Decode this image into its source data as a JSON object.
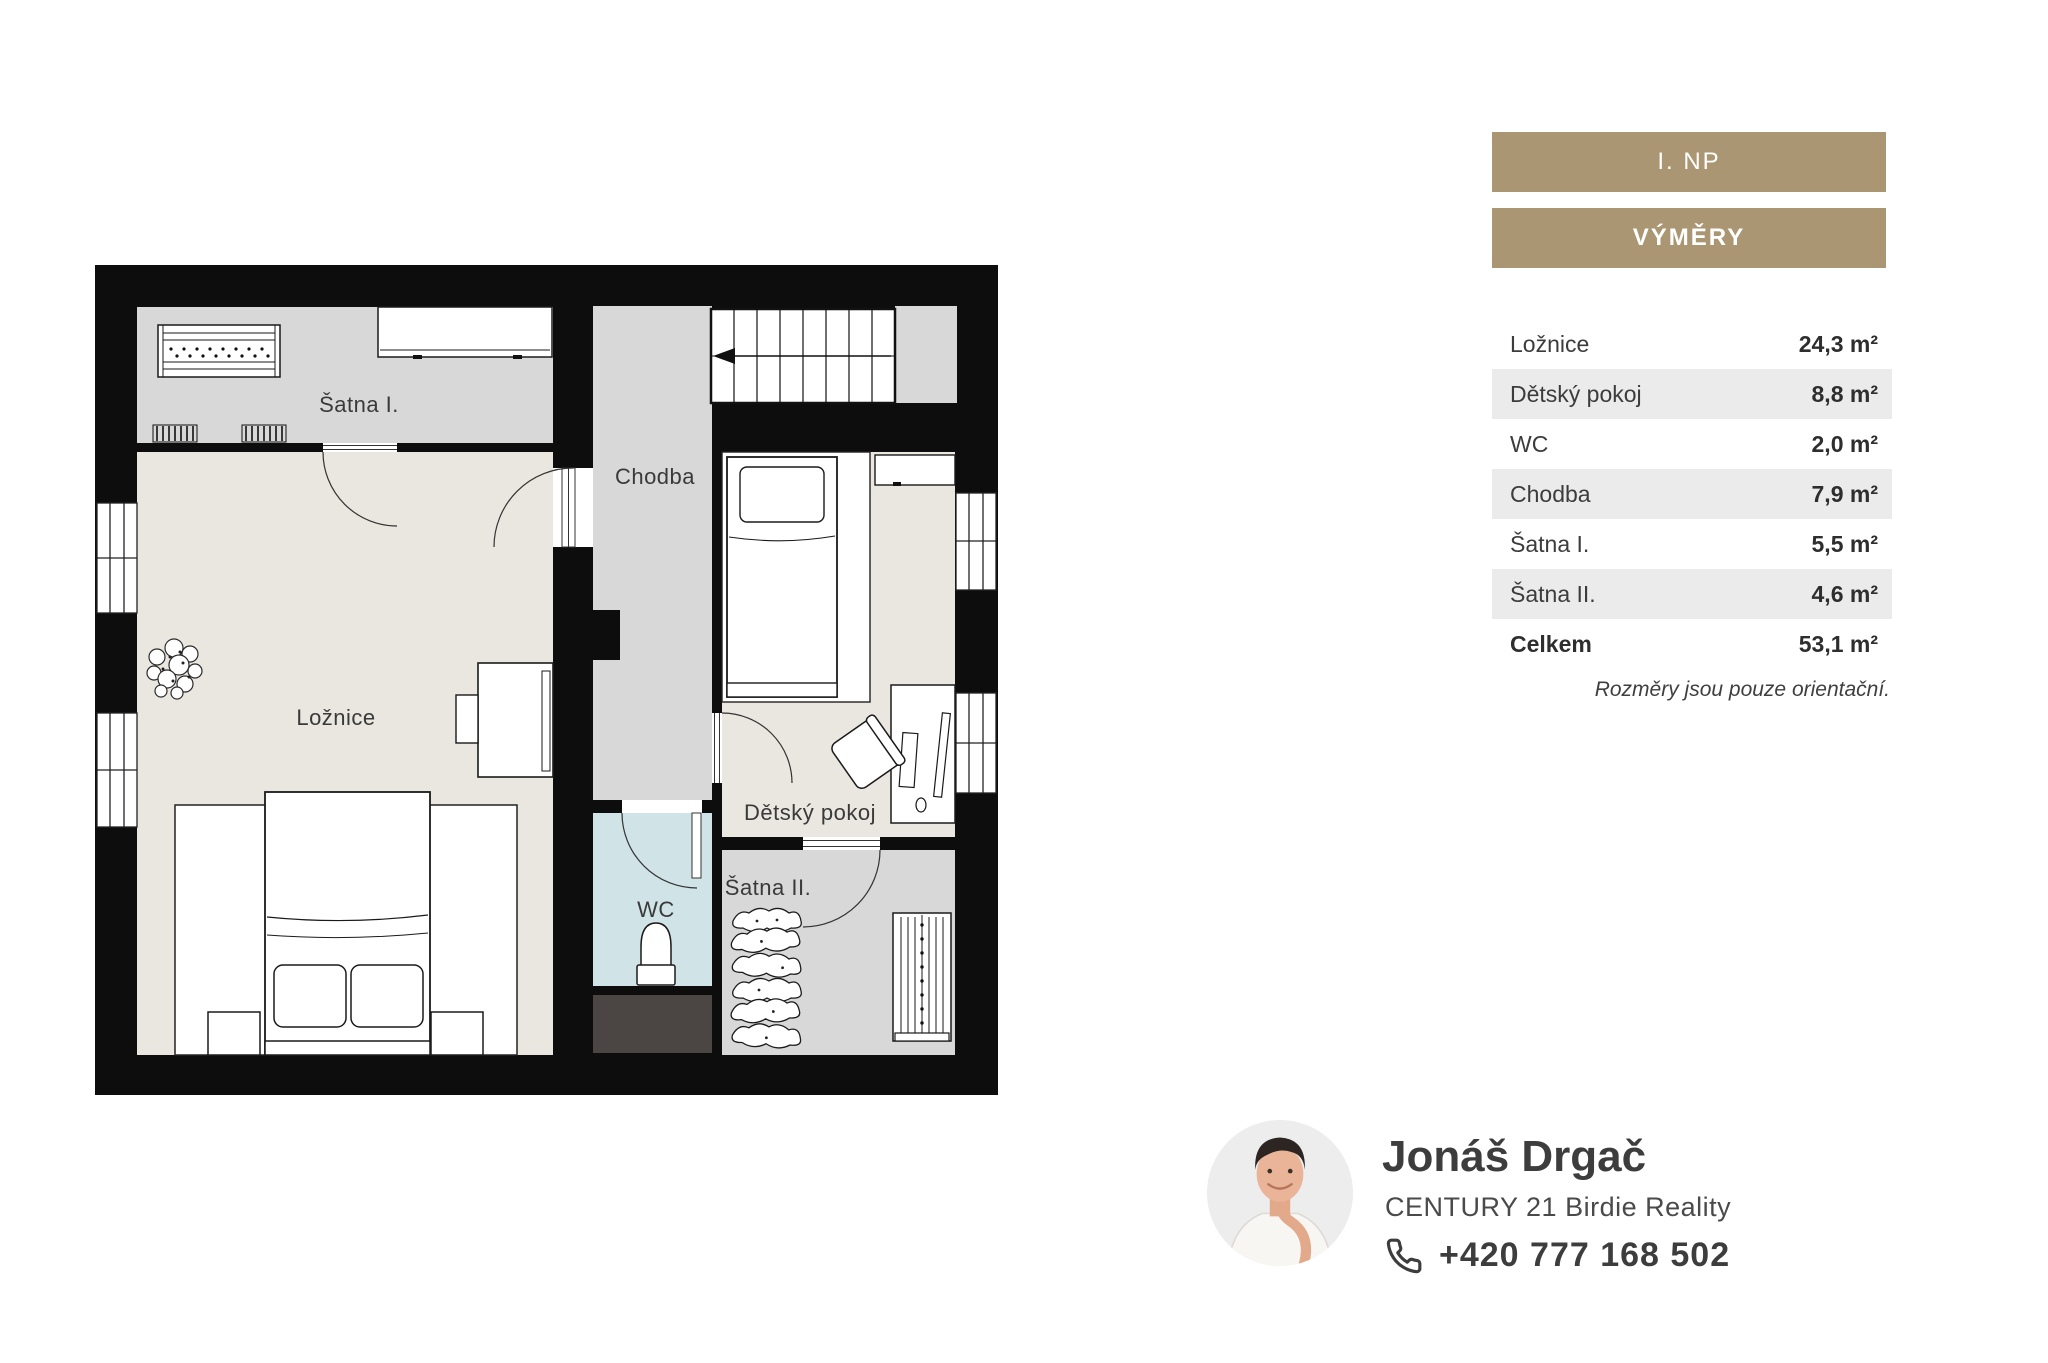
{
  "floorplan": {
    "rooms": [
      {
        "id": "satna1",
        "label": "Šatna I."
      },
      {
        "id": "chodba",
        "label": "Chodba"
      },
      {
        "id": "loznice",
        "label": "Ložnice"
      },
      {
        "id": "detsky",
        "label": "Dětský pokoj"
      },
      {
        "id": "wc",
        "label": "WC"
      },
      {
        "id": "satna2",
        "label": "Šatna II."
      }
    ]
  },
  "panel": {
    "floor_button_label": "I. NP",
    "areas_button_label": "VÝMĚRY",
    "area_rows": [
      {
        "label": "Ložnice",
        "value": "24,3 m²"
      },
      {
        "label": "Dětský pokoj",
        "value": "8,8 m²"
      },
      {
        "label": "WC",
        "value": "2,0 m²"
      },
      {
        "label": "Chodba",
        "value": "7,9 m²"
      },
      {
        "label": "Šatna I.",
        "value": "5,5 m²"
      },
      {
        "label": "Šatna II.",
        "value": "4,6 m²"
      },
      {
        "label": "Celkem",
        "value": "53,1 m²"
      }
    ],
    "note": "Rozměry jsou pouze orientační."
  },
  "agent": {
    "name": "Jonáš Drgač",
    "company": "CENTURY 21 Birdie Reality",
    "phone": "+420 777 168 502"
  },
  "colors": {
    "wall": "#0d0d0d",
    "floor_gray": "#d8d8d8",
    "floor_beige": "#eae6e0",
    "floor_blue": "#d0e4e7",
    "shaft_dark": "#4b4543",
    "accent": "#ab9673"
  }
}
